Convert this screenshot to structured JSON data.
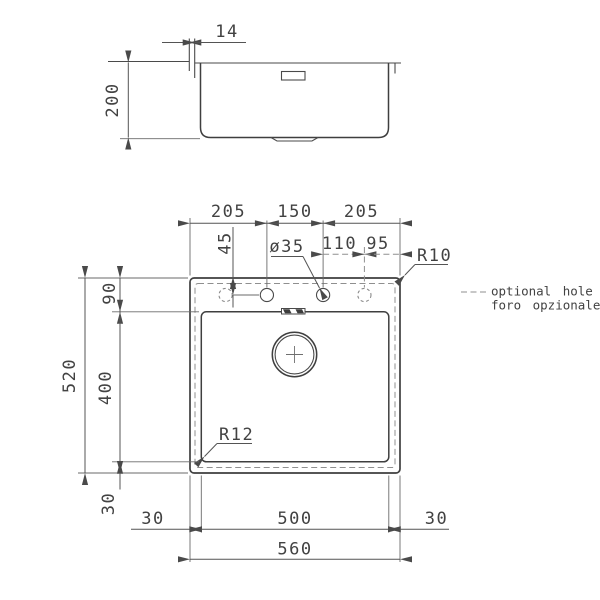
{
  "side_view": {
    "edge_width": "14",
    "bowl_depth": "200"
  },
  "plan_view": {
    "top_dims": [
      "205",
      "150",
      "205"
    ],
    "hole_offset": "45",
    "hole_diameter": "ø35",
    "optional_hole_dims": [
      "110",
      "95"
    ],
    "corner_radius": "R10",
    "bowl_corner_radius": "R12",
    "left_dims": {
      "total": "520",
      "top": "90",
      "bowl": "400",
      "bottom": "30"
    },
    "bottom_dims": {
      "left": "30",
      "bowl": "500",
      "right": "30",
      "total": "560"
    }
  },
  "legend": {
    "line1": "optional hole",
    "line2": "foro opzionale"
  },
  "colors": {
    "line": "#4a4a4a",
    "dashed_line": "#8f8f8f",
    "text": "#424242",
    "background": "#ffffff"
  }
}
